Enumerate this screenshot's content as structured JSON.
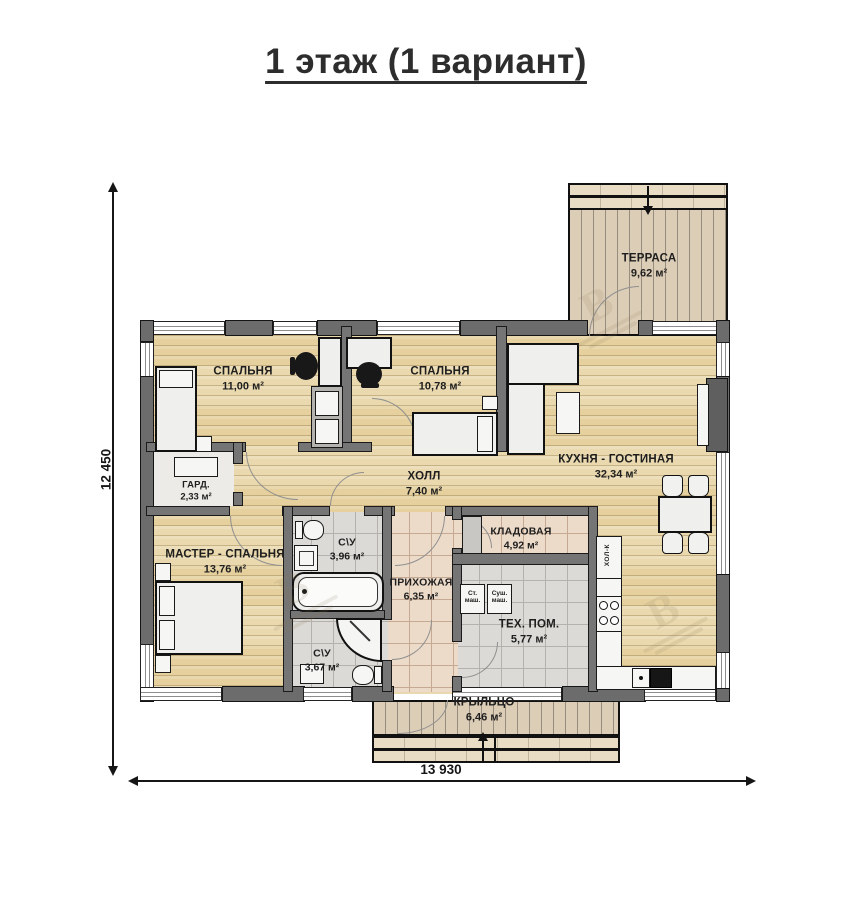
{
  "title": "1 этаж (1 вариант)",
  "dimensions": {
    "height_label": "12 450",
    "width_label": "13 930"
  },
  "rooms": {
    "terrace": {
      "name": "ТЕРРАСА",
      "area": "9,62 м²"
    },
    "bedroom1": {
      "name": "СПАЛЬНЯ",
      "area": "11,00 м²"
    },
    "bedroom2": {
      "name": "СПАЛЬНЯ",
      "area": "10,78 м²"
    },
    "kitchen_living": {
      "name": "КУХНЯ - ГОСТИНАЯ",
      "area": "32,34 м²"
    },
    "hall": {
      "name": "ХОЛЛ",
      "area": "7,40 м²"
    },
    "wardrobe": {
      "name": "ГАРД.",
      "area": "2,33 м²"
    },
    "master_bedroom": {
      "name": "МАСТЕР - СПАЛЬНЯ",
      "area": "13,76 м²"
    },
    "bathroom1": {
      "name": "С\\У",
      "area": "3,96 м²"
    },
    "bathroom2": {
      "name": "С\\У",
      "area": "3,67 м²"
    },
    "entry": {
      "name": "ПРИХОЖАЯ",
      "area": "6,35 м²"
    },
    "storage": {
      "name": "КЛАДОВАЯ",
      "area": "4,92 м²"
    },
    "tech_room": {
      "name": "ТЕХ. ПОМ.",
      "area": "5,77 м²"
    },
    "porch": {
      "name": "КРЫЛЬЦО",
      "area": "6,46 м²"
    }
  },
  "appliances": {
    "washer": "Ст. маш.",
    "dryer": "Суш. маш.",
    "fridge": "ХОЛ-К"
  },
  "watermark": {
    "glyph": "В"
  },
  "colors": {
    "wood_floor": "#e8d5a5",
    "deck": "#dccdb6",
    "tile_grey": "#dcdad6",
    "tile_beige": "#eddbca",
    "wall": "#6c6c6c",
    "title_text": "#2d2d2d"
  }
}
